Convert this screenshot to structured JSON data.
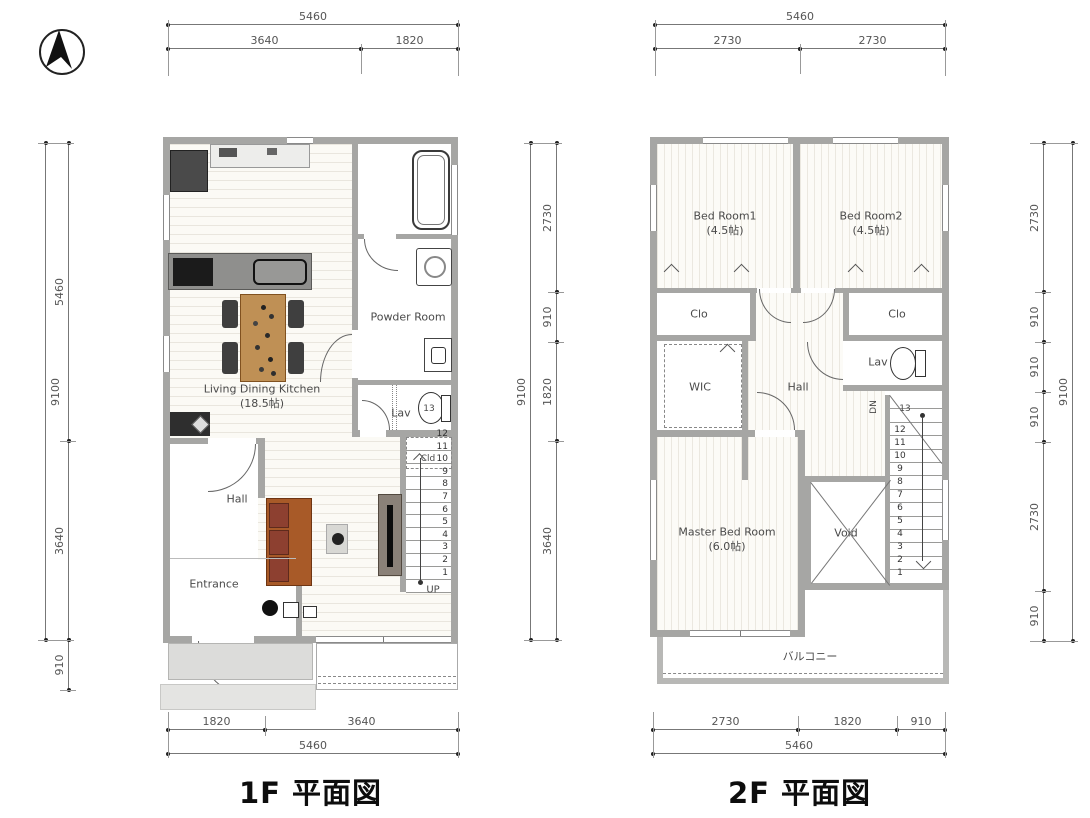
{
  "floor1": {
    "title": "1F 平面図",
    "rooms": {
      "ldk": "Living Dining Kitchen",
      "ldk_size": "(18.5帖)",
      "powder": "Powder Room",
      "lav": "Lav",
      "lav_step": "13",
      "hall": "Hall",
      "entrance": "Entrance",
      "closet": "Cld",
      "stairs_dir": "UP"
    },
    "stair_numbers": [
      "12",
      "11",
      "10",
      "9",
      "8",
      "7",
      "6",
      "5",
      "4",
      "3",
      "2",
      "1"
    ],
    "dims": {
      "top_total": "5460",
      "top_segments": [
        "3640",
        "1820"
      ],
      "bottom_segments": [
        "1820",
        "3640"
      ],
      "bottom_total": "5460",
      "left_total": "9100",
      "left_segments": [
        "5460",
        "3640",
        "910"
      ],
      "right_total": "9100",
      "right_segments": [
        "2730",
        "910",
        "1820",
        "3640"
      ]
    }
  },
  "floor2": {
    "title": "2F 平面図",
    "rooms": {
      "bed1": "Bed Room1",
      "bed1_size": "(4.5帖)",
      "bed2": "Bed Room2",
      "bed2_size": "(4.5帖)",
      "clo_left": "Clo",
      "clo_right": "Clo",
      "wic": "WIC",
      "hall": "Hall",
      "lav": "Lav",
      "master": "Master Bed Room",
      "master_size": "(6.0帖)",
      "void": "Void",
      "balcony": "バルコニー",
      "stairs_dir": "DN",
      "stairs_top_step": "13"
    },
    "stair_numbers": [
      "12",
      "11",
      "10",
      "9",
      "8",
      "7",
      "6",
      "5",
      "4",
      "3",
      "2",
      "1"
    ],
    "dims": {
      "top_total": "5460",
      "top_segments": [
        "2730",
        "2730"
      ],
      "bottom_segments": [
        "2730",
        "1820",
        "910"
      ],
      "bottom_total": "5460",
      "right_total": "9100",
      "right_segments": [
        "2730",
        "910",
        "910",
        "910",
        "2730",
        "910"
      ]
    }
  },
  "colors": {
    "wall": "#a6a6a4",
    "dim_text": "#555555",
    "sofa": "#a85a28",
    "table": "#bf9055",
    "counter": "#8f8f8d"
  }
}
